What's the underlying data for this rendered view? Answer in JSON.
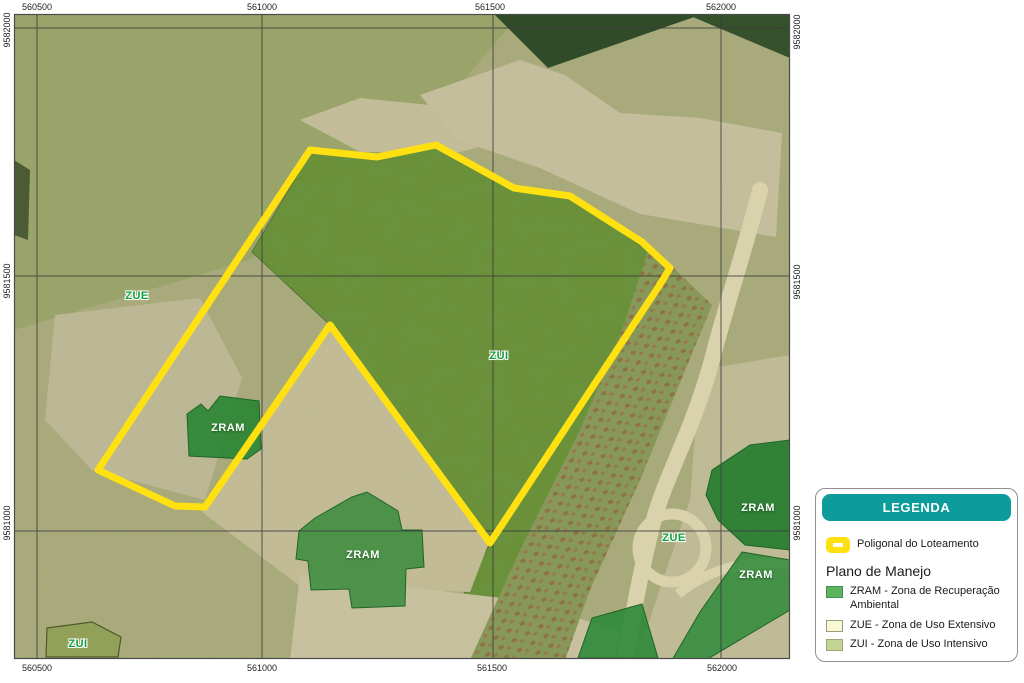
{
  "map": {
    "grid": {
      "top": [
        {
          "text": "560500",
          "x": 37
        },
        {
          "text": "561000",
          "x": 262
        },
        {
          "text": "561500",
          "x": 490
        },
        {
          "text": "562000",
          "x": 721
        }
      ],
      "bottom": [
        {
          "text": "560500",
          "x": 37
        },
        {
          "text": "561000",
          "x": 262
        },
        {
          "text": "561500",
          "x": 492
        },
        {
          "text": "562000",
          "x": 722
        }
      ],
      "left": [
        {
          "text": "9582000",
          "y": 30
        },
        {
          "text": "9581500",
          "y": 281
        },
        {
          "text": "9581000",
          "y": 523
        }
      ],
      "right": [
        {
          "text": "9582000",
          "y": 32
        },
        {
          "text": "9581500",
          "y": 282
        },
        {
          "text": "9581000",
          "y": 523
        }
      ]
    },
    "zone_labels": [
      {
        "text": "ZUE",
        "x": 137,
        "y": 296,
        "style": "green"
      },
      {
        "text": "ZUI",
        "x": 499,
        "y": 356,
        "style": "green"
      },
      {
        "text": "ZRAM",
        "x": 228,
        "y": 428,
        "style": "white"
      },
      {
        "text": "ZRAM",
        "x": 363,
        "y": 555,
        "style": "white"
      },
      {
        "text": "ZRAM",
        "x": 758,
        "y": 508,
        "style": "white"
      },
      {
        "text": "ZUE",
        "x": 674,
        "y": 538,
        "style": "green"
      },
      {
        "text": "ZRAM",
        "x": 756,
        "y": 575,
        "style": "white"
      },
      {
        "text": "ZUI",
        "x": 78,
        "y": 644,
        "style": "green"
      }
    ]
  },
  "legend": {
    "title": "LEGENDA",
    "polygon_item": {
      "label": "Poligonal do Loteamento"
    },
    "section_title": "Plano de Manejo",
    "items": [
      {
        "code": "ZRAM",
        "label": "ZRAM - Zona de Recuperação Ambiental",
        "color": "#5eb360",
        "border": "#3f8f50"
      },
      {
        "code": "ZUE",
        "label": "ZUE - Zona de Uso Extensivo",
        "color": "#f8f8d2",
        "border": "#9a9a85"
      },
      {
        "code": "ZUI",
        "label": "ZUI - Zona de Uso Intensivo",
        "color": "#c4d494",
        "border": "#9aa578"
      }
    ]
  },
  "colors": {
    "legend_teal": "#0d9b9b",
    "polygon_yellow": "#ffe112",
    "zram_green": "#2e8736",
    "zram_swatch": "#5eb360",
    "zue_pale": "#f8f8d2",
    "zui_olive": "#c4d494",
    "label_green": "#0fa03c"
  }
}
